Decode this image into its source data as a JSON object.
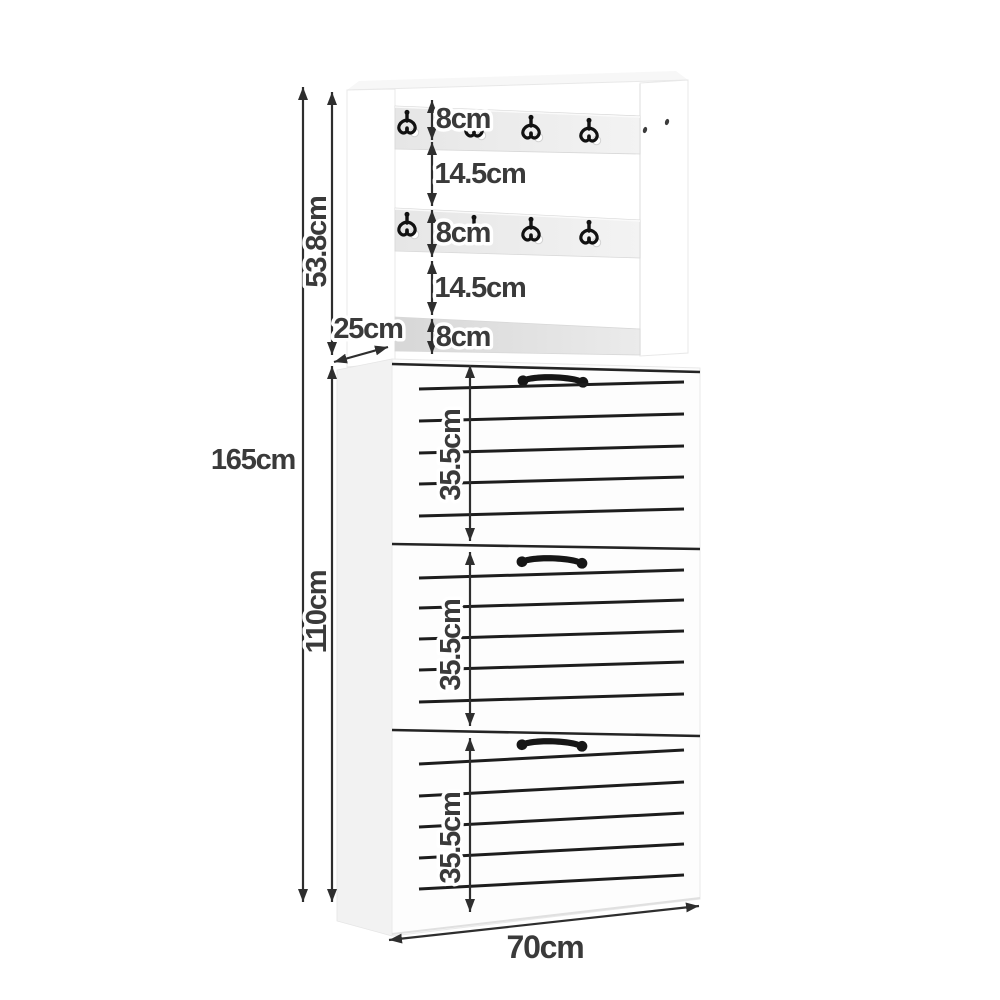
{
  "diagram": {
    "description_labels": {
      "overall_height": "165cm",
      "rack_height": "53.8cm",
      "cabinet_height": "110cm",
      "depth": "25cm",
      "width": "70cm",
      "rail1_height": "8cm",
      "gap1": "14.5cm",
      "rail2_height": "8cm",
      "gap2": "14.5cm",
      "rail3_height": "8cm",
      "drawer1_height": "35.5cm",
      "drawer2_height": "35.5cm",
      "drawer3_height": "35.5cm"
    },
    "furniture": {
      "hook_rails": 2,
      "hooks_per_rail": 4,
      "drawers": 3,
      "slats_per_drawer": 5,
      "icons": [
        "coat-hook-icon",
        "drawer-handle-icon",
        "dimension-arrow-icon"
      ]
    },
    "colors": {
      "background": "#ffffff",
      "dimension_line": "#2e2e2e",
      "label_text": "#3a3a3a",
      "label_halo": "#ffffff",
      "furniture_white": "#fdfdfd",
      "side_panel": "#f2f2f2",
      "rail_gray": "#e9e9e9",
      "rail_shadow": "#d9d9d9",
      "slat_black": "#1d1d1d",
      "hardware_black": "#161616"
    }
  }
}
